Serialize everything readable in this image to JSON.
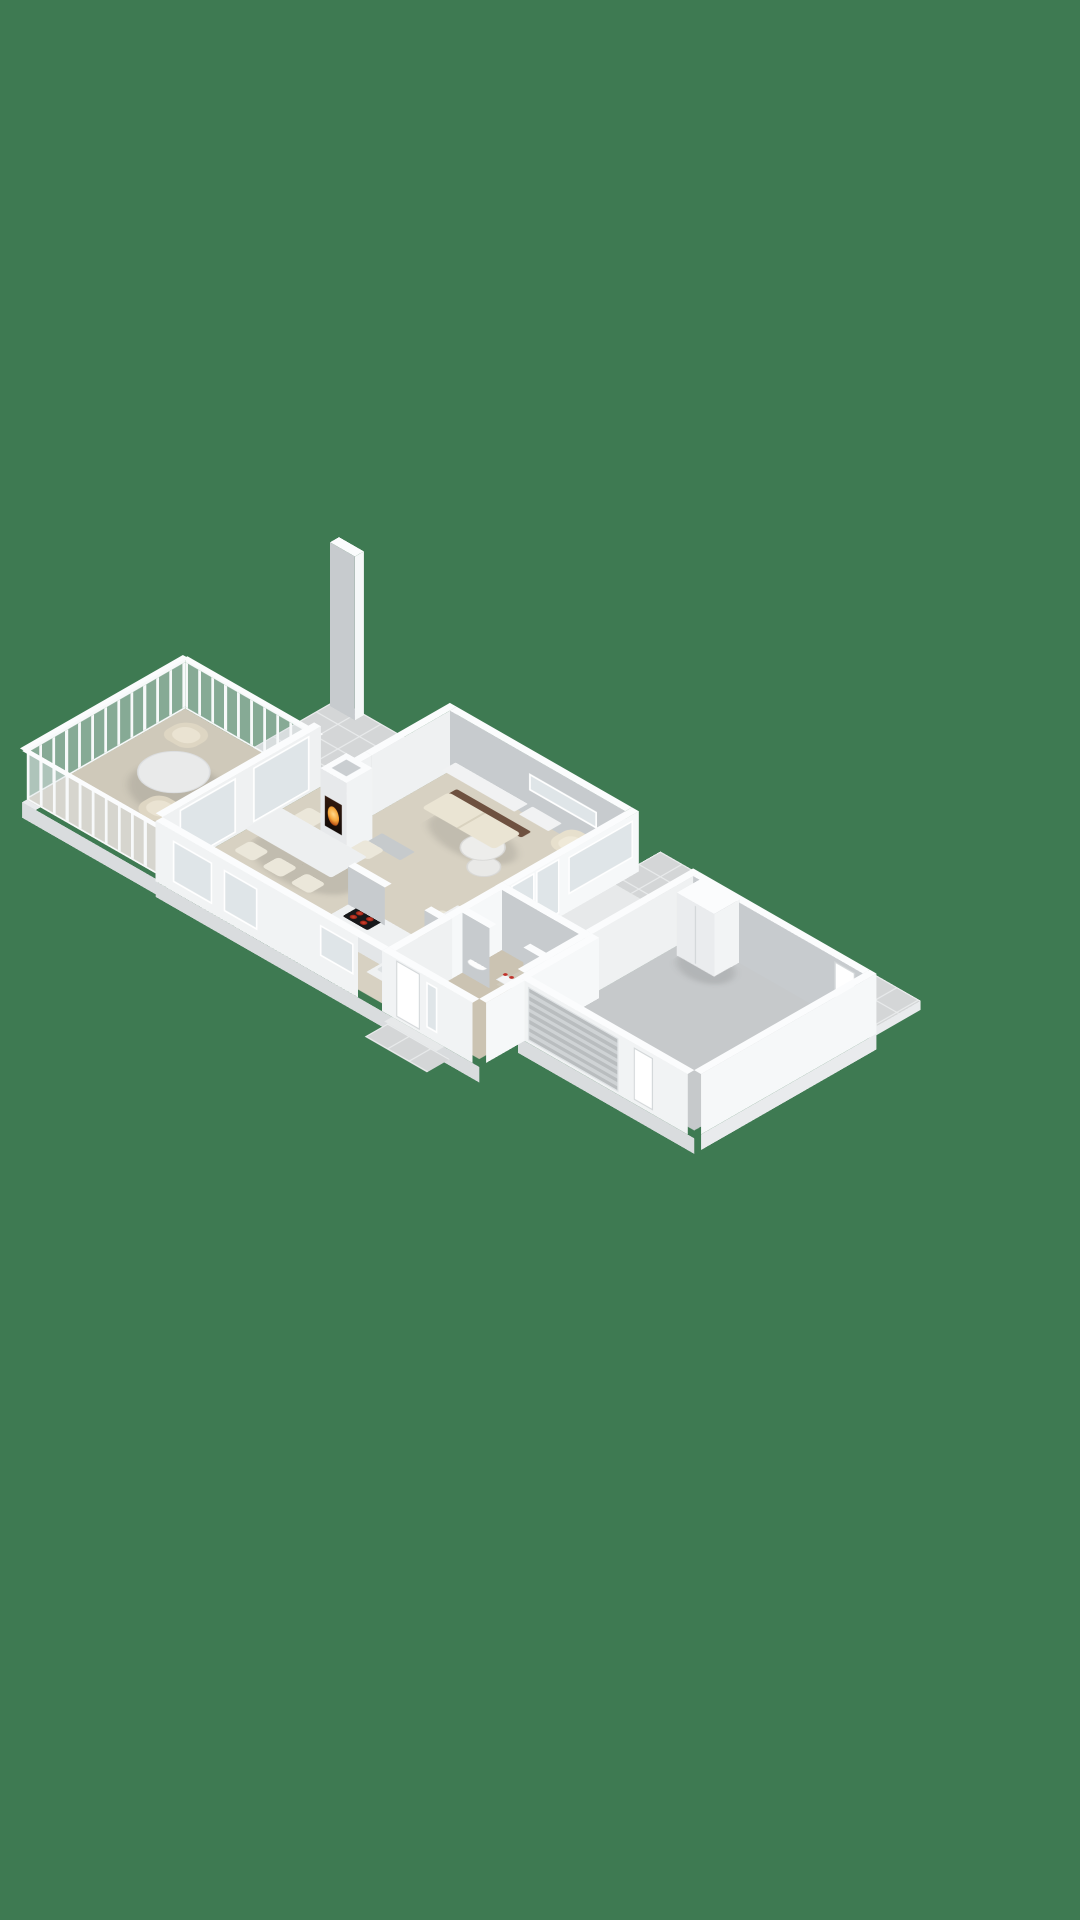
{
  "scene": {
    "type": "isometric-3d-floorplan-render",
    "description": "Single-storey house 3D floor plan viewed from above at an angle, no text labels, on a plain green backdrop",
    "background_color": "#3e7a52"
  },
  "colors": {
    "bg": "#3e7a52",
    "floor": "#d7d1c2",
    "floor_porch": "#cfc9ba",
    "floor_hall": "#cbc3b2",
    "floor_bath": "#d0cabb",
    "garage": "#c6c9cb",
    "concrete": "#e7e9ea",
    "tile": "#d4d6d7",
    "tileline": "#e9ebec",
    "wallx": "#c7cbce",
    "wally": "#eff1f2",
    "wallxO": "#f1f3f4",
    "wallyO": "#f6f8f9",
    "cap": "#fbfcfd",
    "plx": "#d9dcde",
    "ply": "#e9ebed",
    "rail": "#f7f9fa",
    "glass": "#dfe5e8",
    "frame": "#ffffff",
    "slat1": "#b9bdbf",
    "slat2": "#cfd3d5",
    "wood": "#6e5140",
    "cream": "#e7e0cd",
    "cream2": "#efe9d8",
    "marble": "#ededeb",
    "counter": "#eff1f2",
    "cooktop": "#17181a",
    "burner": "#d84430",
    "fire": "#f6a83c",
    "firedark": "#241209"
  },
  "rooms": [
    {
      "id": 0,
      "name": "Living room",
      "floor": "beige carpet"
    },
    {
      "id": 1,
      "name": "Dining room",
      "floor": "beige carpet"
    },
    {
      "id": 2,
      "name": "Kitchen",
      "floor": "beige"
    },
    {
      "id": 3,
      "name": "Enclosed porch / conservatory",
      "floor": "beige, balustraded glass walls"
    },
    {
      "id": 4,
      "name": "North-west terrace",
      "floor": "grey tiles, chimney stack"
    },
    {
      "id": 5,
      "name": "North-east terrace",
      "floor": "grey tiles"
    },
    {
      "id": 6,
      "name": "Side court",
      "floor": "concrete"
    },
    {
      "id": 7,
      "name": "Hallway",
      "floor": "beige carpet, wash basin, flower planter"
    },
    {
      "id": 8,
      "name": "Bathroom",
      "floor": "beige tiles"
    },
    {
      "id": 9,
      "name": "Garage",
      "floor": "grey concrete, wardrobe cabinet, slatted garage door"
    },
    {
      "id": 10,
      "name": "Entry step",
      "floor": "tiled pad with step"
    }
  ],
  "furniture": [
    {
      "name": "Sofa",
      "room": "Living room",
      "style": "cream cushions on dark wood base"
    },
    {
      "name": "Armchair",
      "room": "Living room"
    },
    {
      "name": "Armchair",
      "room": "Living room"
    },
    {
      "name": "Round coffee table large",
      "room": "Living room",
      "top": "white marble"
    },
    {
      "name": "Round coffee table small",
      "room": "Living room",
      "top": "white marble"
    },
    {
      "name": "Sideboard",
      "room": "Living room"
    },
    {
      "name": "Desk with chair",
      "room": "Living room"
    },
    {
      "name": "Wood-burning fireplace, lit",
      "room": "Living room"
    },
    {
      "name": "Grey bench",
      "room": "Living room"
    },
    {
      "name": "Dining table with 6 chairs",
      "room": "Dining room"
    },
    {
      "name": "Kitchen counter with black cooktop, 4 red burners and sink",
      "room": "Kitchen"
    },
    {
      "name": "Round bistro table with 2 wicker chairs",
      "room": "Enclosed porch"
    },
    {
      "name": "Wash basin",
      "room": "Hallway"
    },
    {
      "name": "Planter with red flowers",
      "room": "Hallway"
    },
    {
      "name": "Wardrobe cabinet",
      "room": "Garage"
    },
    {
      "name": "Chimney stack",
      "room": "North-west terrace"
    }
  ]
}
